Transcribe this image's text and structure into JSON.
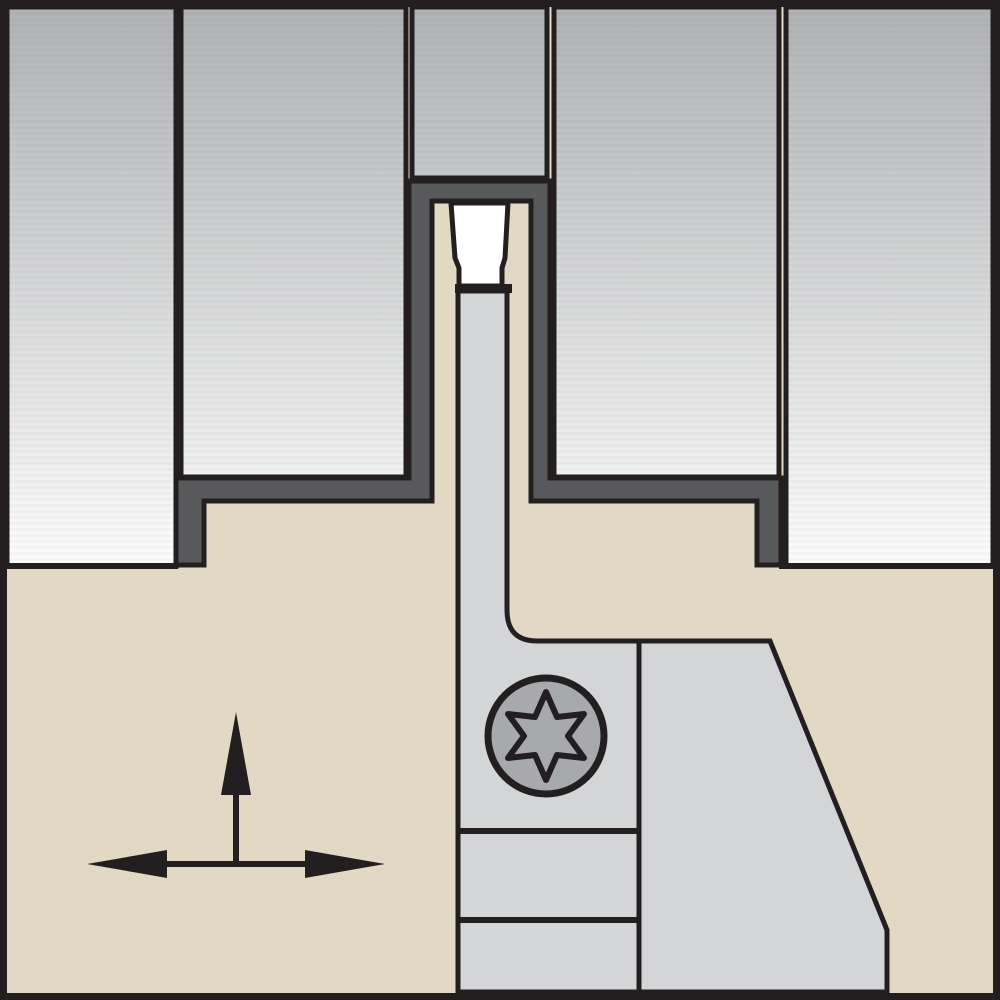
{
  "figure": {
    "kind": "technical-cross-section-diagram",
    "subject": "Grooving / cut-off toolholder cross-section: workpiece with machined groove, blade with cutting insert, Torx clamp screw, feed-direction arrows"
  },
  "colors": {
    "outline": "#231f20",
    "holder_tan": "#e2d8c3",
    "workpiece_top": "#b0b2b4",
    "workpiece_mid": "#d6d7d8",
    "workpiece_bottom": "#fcfcfc",
    "groove_dark_gray": "#58595b",
    "blade_light_gray": "#d4d5d7",
    "screw_gray": "#a7a9ac",
    "insert_white": "#ffffff"
  },
  "parts": {
    "frame": "image border frame",
    "workpiece": "workpiece (gradient steel section)",
    "groove_channel": "machined groove channel wall",
    "holder": "toolholder body",
    "blade": "parting blade",
    "insert": "cutting insert",
    "insert_seat": "insert seat",
    "screw": "Torx clamp screw",
    "arrows": "feed direction arrows"
  }
}
